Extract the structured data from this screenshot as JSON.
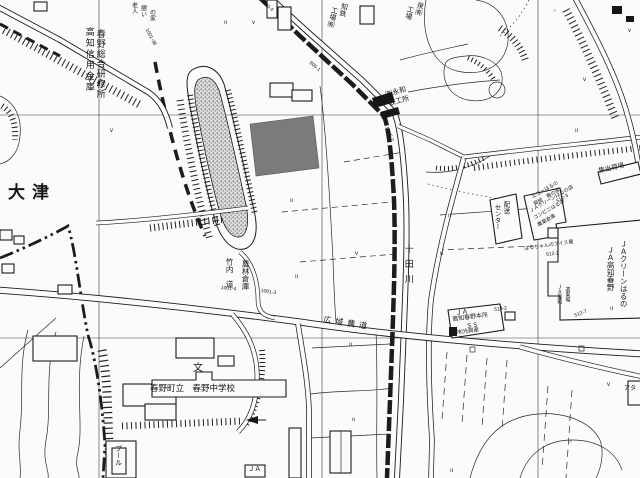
{
  "map": {
    "paper_color": "#fbfbf9",
    "ink_color": "#1c1c1c",
    "highlight_parcel_color": "#7b7b7b",
    "mound_fill_color": "#dddddb",
    "river_name": "十田川",
    "labels": [
      {
        "name": "label-kochi-shinyo-kinko",
        "text": "高知信用金庫",
        "x": 84,
        "y": 27,
        "size": 9,
        "v": true,
        "ls": 2
      },
      {
        "name": "label-haruno-sogo-kenshujo",
        "text": "春野総合研修所",
        "x": 95,
        "y": 29,
        "size": 9,
        "v": true,
        "ls": 1
      },
      {
        "name": "label-rojin-ikoi-no-ie-1",
        "text": "老人",
        "x": 130,
        "y": 2,
        "size": 6,
        "v": true
      },
      {
        "name": "label-rojin-ikoi-no-ie-2",
        "text": "憩い",
        "x": 139,
        "y": 5,
        "size": 6,
        "v": true
      },
      {
        "name": "label-rojin-ikoi-no-ie-3",
        "text": "の家",
        "x": 148,
        "y": 9,
        "size": 6,
        "v": true
      },
      {
        "name": "label-kochi-tekko-1",
        "text": "知鉄",
        "x": 341,
        "y": 2,
        "size": 7,
        "v": true,
        "rot": 14
      },
      {
        "name": "label-kochi-tekko-2",
        "text": "工場㈲",
        "x": 331,
        "y": 6,
        "size": 7,
        "v": true,
        "rot": 14
      },
      {
        "name": "label-izumi-kojo-1",
        "text": "泉㈲",
        "x": 417,
        "y": 1,
        "size": 7,
        "v": true,
        "rot": 14
      },
      {
        "name": "label-izumi-kojo-2",
        "text": "工場",
        "x": 407,
        "y": 5,
        "size": 7,
        "v": true,
        "rot": 14
      },
      {
        "name": "label-eiwa-tekkosho-1",
        "text": "㈲永和",
        "x": 385,
        "y": 92,
        "size": 7,
        "rot": -16
      },
      {
        "name": "label-eiwa-tekkosho-2",
        "text": "鉄工所",
        "x": 388,
        "y": 101,
        "size": 7,
        "rot": -16
      },
      {
        "name": "label-otsu",
        "text": "大津",
        "x": 8,
        "y": 184,
        "size": 17,
        "ls": 7,
        "bold": true
      },
      {
        "name": "label-takeuchi-michi",
        "text": "竹内　道",
        "x": 225,
        "y": 258,
        "size": 7.5,
        "v": true
      },
      {
        "name": "label-norin-soko",
        "text": "農林倉庫",
        "x": 241,
        "y": 260,
        "size": 7.5,
        "v": true
      },
      {
        "name": "label-toda-gawa",
        "text": "十田川",
        "x": 403,
        "y": 244,
        "size": 9,
        "v": true,
        "ls": 6
      },
      {
        "name": "label-koiki-nodo",
        "text": "広域農道",
        "x": 324,
        "y": 316,
        "size": 8,
        "rot": 9,
        "ls": 4
      },
      {
        "name": "label-haruno-chugakko",
        "text": "春野町立　春野中学校",
        "x": 150,
        "y": 384,
        "size": 8.5
      },
      {
        "name": "symbol-school",
        "text": "文",
        "x": 193,
        "y": 364,
        "size": 10
      },
      {
        "name": "label-pool",
        "text": "プール",
        "x": 114,
        "y": 445,
        "size": 7,
        "v": true
      },
      {
        "name": "label-shushukkajo",
        "text": "集出荷場",
        "x": 598,
        "y": 168,
        "size": 6.5,
        "rot": -13
      },
      {
        "name": "label-ja-clean-haruno",
        "text": "ＪＡクリーンはるの",
        "x": 619,
        "y": 240,
        "size": 7.5,
        "v": true
      },
      {
        "name": "label-ja-kochi-haruno",
        "text": "ＪＡ高知春野",
        "x": 606,
        "y": 246,
        "size": 7.5,
        "v": true
      },
      {
        "name": "label-haiso-center-1",
        "text": "配送",
        "x": 502,
        "y": 201,
        "size": 6.5,
        "v": true
      },
      {
        "name": "label-haiso-center-2",
        "text": "センター",
        "x": 493,
        "y": 204,
        "size": 6.5,
        "v": true
      },
      {
        "name": "label-echo-haruno",
        "text": "エコーはるの",
        "x": 531,
        "y": 196,
        "size": 5,
        "rot": -30
      },
      {
        "name": "label-haru-no-ie",
        "text": "貸館　春の家",
        "x": 533,
        "y": 203,
        "size": 5,
        "rot": -30
      },
      {
        "name": "label-ja-green-haruno-ten",
        "text": "ＪＡグリーンはるの店",
        "x": 529,
        "y": 210,
        "size": 5,
        "rot": -30
      },
      {
        "name": "label-conveni-haruno",
        "text": "コンビニはるの",
        "x": 533,
        "y": 217,
        "size": 5,
        "rot": -30
      },
      {
        "name": "label-nogyo-soko",
        "text": "農業倉庫",
        "x": 537,
        "y": 224,
        "size": 5,
        "rot": -30
      },
      {
        "name": "label-haru-chan-ice",
        "text": "はるちゃんのアイス屋",
        "x": 524,
        "y": 247,
        "size": 5,
        "rot": -8
      },
      {
        "name": "parcel-number-512-2",
        "text": "512-2",
        "x": 546,
        "y": 253,
        "size": 5,
        "rot": -8
      },
      {
        "name": "parcel-number-512-3",
        "text": "512-3",
        "x": 556,
        "y": 200,
        "size": 5,
        "rot": -30
      },
      {
        "name": "label-ja-kochi-sub",
        "text": "ＪＡ高知",
        "x": 556,
        "y": 284,
        "size": 5,
        "v": true
      },
      {
        "name": "label-senkajo",
        "text": "選果場",
        "x": 564,
        "y": 287,
        "size": 5,
        "v": true
      },
      {
        "name": "parcel-number-512-7",
        "text": "512-7",
        "x": 574,
        "y": 314,
        "size": 5,
        "rot": -20
      },
      {
        "name": "label-ja-ss",
        "text": "ＪＡ",
        "x": 455,
        "y": 310,
        "size": 6.5,
        "rot": -7
      },
      {
        "name": "label-ja-honjo",
        "text": "高知春野本所",
        "x": 452,
        "y": 317,
        "size": 6,
        "rot": -7
      },
      {
        "name": "label-ss",
        "text": "ＳＳ",
        "x": 466,
        "y": 324,
        "size": 6,
        "rot": -7
      },
      {
        "name": "label-hikari-kosan",
        "text": "㈲光興産",
        "x": 457,
        "y": 331,
        "size": 5.5,
        "rot": -7
      },
      {
        "name": "parcel-number-513-2",
        "text": "513-2",
        "x": 494,
        "y": 308,
        "size": 5,
        "rot": -7
      },
      {
        "name": "label-ja-box",
        "text": "ＪＡ",
        "x": 248,
        "y": 466,
        "size": 6.5
      },
      {
        "name": "label-ata",
        "text": "アタ",
        "x": 624,
        "y": 386,
        "size": 6
      },
      {
        "name": "parcel-number-1001-38",
        "text": "1001-38",
        "x": 148,
        "y": 28,
        "size": 5,
        "rot": 62
      },
      {
        "name": "parcel-number-805-1",
        "text": "805-1",
        "x": 311,
        "y": 61,
        "size": 5,
        "rot": 40
      },
      {
        "name": "parcel-number-800-4",
        "text": "800-4",
        "x": 264,
        "y": 1,
        "size": 5,
        "rot": 40
      },
      {
        "name": "parcel-number-1005-2",
        "text": "1005-2",
        "x": 388,
        "y": 126,
        "size": 5,
        "rot": 68
      },
      {
        "name": "parcel-number-1001-4",
        "text": "1001-4",
        "x": 221,
        "y": 286,
        "size": 5,
        "rot": 5
      },
      {
        "name": "parcel-number-1001-3",
        "text": "1001-3",
        "x": 261,
        "y": 289,
        "size": 5,
        "rot": 8
      },
      {
        "name": "paddy-symbol",
        "text": "ıı",
        "x": 224,
        "y": 20,
        "size": 6
      },
      {
        "name": "paddy-symbol",
        "text": "ıı",
        "x": 290,
        "y": 198,
        "size": 6
      },
      {
        "name": "paddy-symbol",
        "text": "ıı",
        "x": 295,
        "y": 274,
        "size": 6
      },
      {
        "name": "paddy-symbol",
        "text": "ıı",
        "x": 448,
        "y": 213,
        "size": 6
      },
      {
        "name": "paddy-symbol",
        "text": "ıı",
        "x": 440,
        "y": 251,
        "size": 6
      },
      {
        "name": "paddy-symbol",
        "text": "ıı",
        "x": 349,
        "y": 342,
        "size": 6
      },
      {
        "name": "paddy-symbol",
        "text": "ıı",
        "x": 352,
        "y": 417,
        "size": 6
      },
      {
        "name": "paddy-symbol",
        "text": "ıı",
        "x": 450,
        "y": 468,
        "size": 6
      },
      {
        "name": "paddy-symbol",
        "text": "ıı",
        "x": 610,
        "y": 306,
        "size": 6
      },
      {
        "name": "paddy-symbol",
        "text": "ıı",
        "x": 575,
        "y": 128,
        "size": 6
      },
      {
        "name": "grass-symbol",
        "text": "v",
        "x": 252,
        "y": 20,
        "size": 6
      },
      {
        "name": "grass-symbol",
        "text": "v",
        "x": 583,
        "y": 77,
        "size": 6
      },
      {
        "name": "grass-symbol",
        "text": "v",
        "x": 355,
        "y": 251,
        "size": 6
      },
      {
        "name": "grass-symbol",
        "text": "v",
        "x": 607,
        "y": 382,
        "size": 6
      },
      {
        "name": "grass-symbol",
        "text": "v",
        "x": 110,
        "y": 128,
        "size": 6
      },
      {
        "name": "grass-symbol",
        "text": "v",
        "x": 628,
        "y": 28,
        "size": 6
      },
      {
        "name": "orchard-symbol",
        "text": "○",
        "x": 553,
        "y": 9,
        "size": 5
      },
      {
        "name": "orchard-symbol",
        "text": "○",
        "x": 569,
        "y": 440,
        "size": 5
      }
    ]
  }
}
